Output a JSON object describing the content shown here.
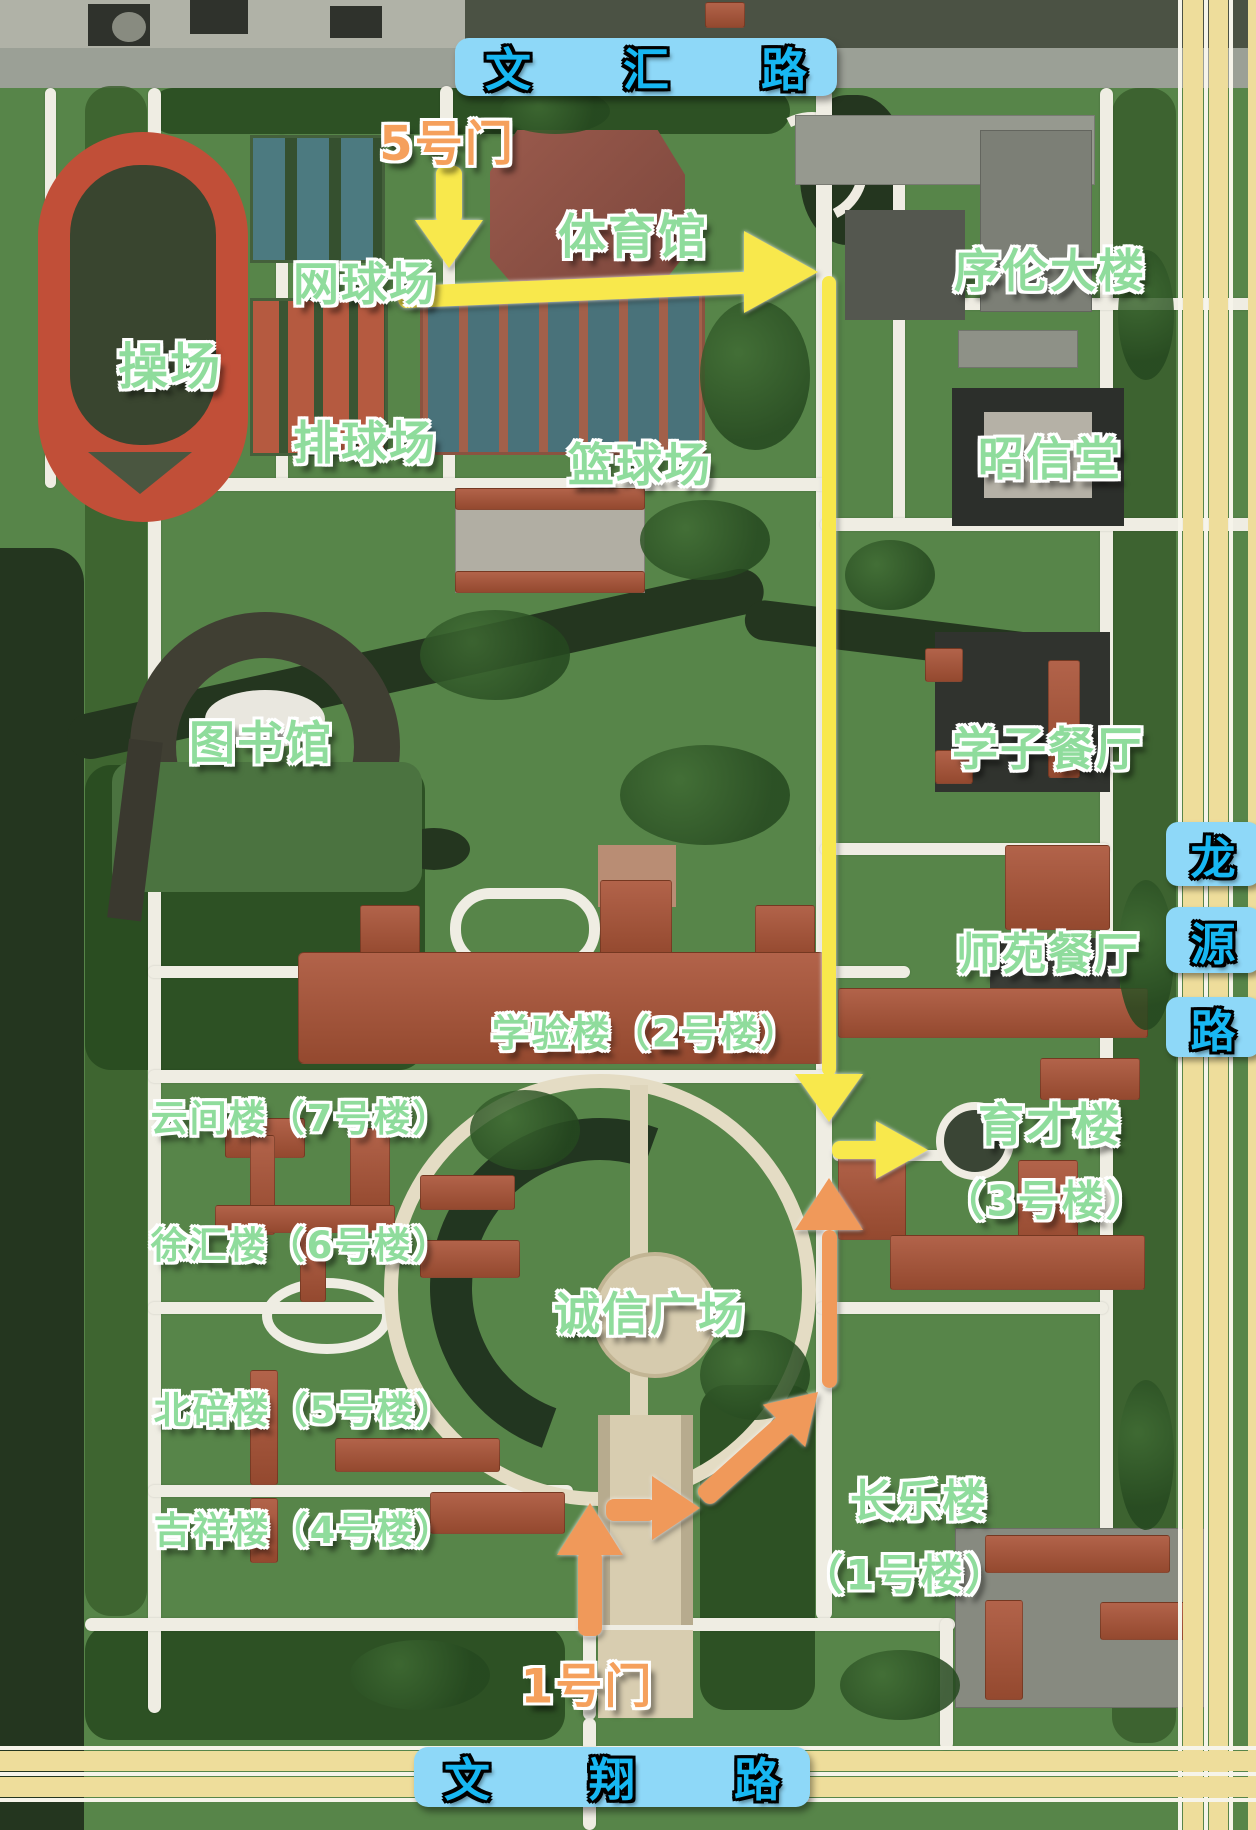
{
  "roads": {
    "top": {
      "name": "文汇路",
      "chars": [
        "文",
        "汇",
        "路"
      ]
    },
    "bottom": {
      "name": "文翔路",
      "chars": [
        "文",
        "翔",
        "路"
      ]
    },
    "right": {
      "name": "龙源路",
      "chars": [
        "龙",
        "源",
        "路"
      ]
    }
  },
  "gates": {
    "gate5": "5号门",
    "gate1": "1号门"
  },
  "places": {
    "playground": "操场",
    "tennis": "网球场",
    "volleyball": "排球场",
    "basketball": "篮球场",
    "gym": "体育馆",
    "xulun": "序伦大楼",
    "zhaoxin": "昭信堂",
    "library": "图书馆",
    "xuezi_canteen": "学子餐厅",
    "shiyuan_canteen": "师苑餐厅",
    "xueyan": "学验楼（2号楼）",
    "yunjian": "云间楼（7号楼）",
    "xuhui": "徐汇楼（6号楼）",
    "beibei": "北碚楼（5号楼）",
    "jixiang": "吉祥楼（4号楼）",
    "chengxin_square": "诚信广场",
    "yucai_line1": "育才楼",
    "yucai_line2": "（3号楼）",
    "changle_line1": "长乐楼",
    "changle_line2": "（1号楼）"
  },
  "routes": [
    {
      "id": "route-from-gate5",
      "color": "yellow"
    },
    {
      "id": "route-from-gate1",
      "color": "orange"
    }
  ],
  "colors": {
    "place_label": "#8fdc9c",
    "gate_label": "#f5a05c",
    "route_yellow": "#f8e84c",
    "route_orange": "#f0995a",
    "banner_bg": "#8ed8f8",
    "banner_text": "#17b7f2"
  }
}
